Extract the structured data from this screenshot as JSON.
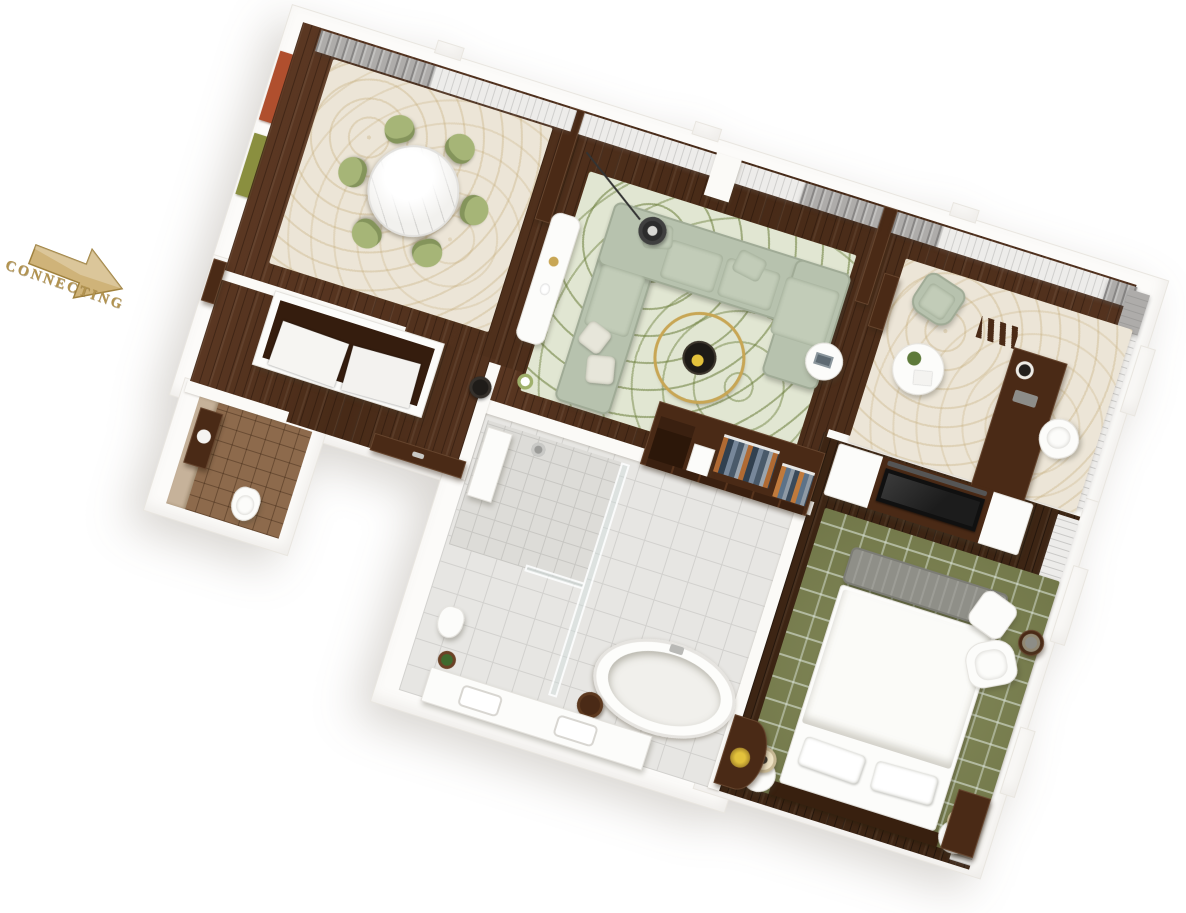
{
  "scene": {
    "type": "3d-floor-plan-render",
    "description": "Isometric 3D floor plan of a hotel suite, rotated, on white background",
    "background": "#ffffff"
  },
  "connecting": {
    "label": "CONNECTING",
    "color": "#b2934f",
    "arrow_color": "#cfb379"
  },
  "palette": {
    "wall_white": "#fcfbf9",
    "wood_floor": "#53321e",
    "wood_floor_dark": "#3d2514",
    "rug_cream": "#ece5d7",
    "rug_living_pattern": "#687b37",
    "rug_olive": "#7b814f",
    "sofa_sage": "#b7c2ae",
    "chair_green": "#a6b577",
    "tile_light": "#e7e6e3",
    "tile_brown": "#8d6a4c",
    "curtain_gray": "#aeacaa",
    "curtain_sheer": "#edecea",
    "accent_gold": "#c8a654",
    "art_rust": "#b04f2e",
    "art_olive": "#8a8f3f"
  },
  "rooms": [
    {
      "id": "dining-room",
      "furniture": [
        "round-marble-dining-table",
        "six-green-dining-chairs",
        "cream-area-rug",
        "rust-wall-art",
        "olive-wall-art",
        "window-curtains"
      ]
    },
    {
      "id": "living-room",
      "furniture": [
        "l-shaped-sectional-sofa",
        "round-wood-coffee-table",
        "white-console-table",
        "arc-floor-lamp",
        "green-armchair",
        "side-table-with-lamp",
        "white-side-table",
        "patterned-rug"
      ]
    },
    {
      "id": "study",
      "furniture": [
        "sage-armchair",
        "round-white-table-with-plant",
        "writing-desk",
        "desk-lamp",
        "white-desk-chair",
        "zigzag-book-rack",
        "cream-rug"
      ]
    },
    {
      "id": "foyer",
      "furniture": [
        "white-closet-unit",
        "black-floor-lamp",
        "entry-door",
        "connecting-door"
      ]
    },
    {
      "id": "powder-room",
      "furniture": [
        "toilet",
        "dark-vanity"
      ]
    },
    {
      "id": "bathroom",
      "furniture": [
        "walk-in-shower",
        "shower-bench",
        "glass-partition",
        "freestanding-oval-bathtub",
        "dark-stool",
        "double-sink-vanity",
        "toilet",
        "potted-plant"
      ]
    },
    {
      "id": "walk-in-closet",
      "furniture": [
        "open-wardrobe-with-hanging-clothes",
        "drawer-base"
      ]
    },
    {
      "id": "bedroom",
      "furniture": [
        "king-bed-white-bedding",
        "gray-foot-bench",
        "two-round-nightstands",
        "two-table-lamps",
        "white-armchair",
        "round-ottoman",
        "dark-side-table",
        "media-console-with-tv",
        "curved-dressing-table",
        "olive-patterned-rug",
        "window-curtains"
      ]
    }
  ]
}
